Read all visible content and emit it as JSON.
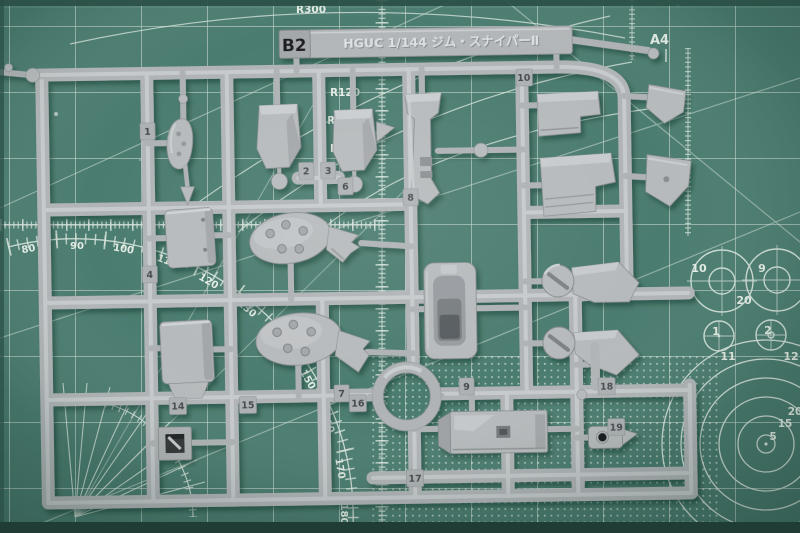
{
  "scene": {
    "description": "Photograph of a light gray plastic model kit runner (sprue B2 of HGUC 1/144 GM Sniper II) lying on a green A4 self-healing cutting mat with white grid, protractor arcs and circle templates"
  },
  "sprue": {
    "tag_label": "B2",
    "kit_label": "HGUC 1/144 ジム・スナイパーⅡ",
    "plastic_color": "#b6babc",
    "part_numbers": [
      "1",
      "2",
      "3",
      "4",
      "6",
      "7",
      "8",
      "9",
      "10",
      "14",
      "15",
      "16",
      "17",
      "18",
      "19"
    ]
  },
  "mat": {
    "surface_color": "#4b7c70",
    "grid_color": "#d5e2da",
    "sheet_size_label": "A4",
    "radius_labels": [
      "R300",
      "R120",
      "R100",
      "R80"
    ],
    "protractor_labels": [
      "80",
      "90",
      "100",
      "110",
      "120",
      "130",
      "150",
      "160",
      "170",
      "180"
    ],
    "diameter_circle_labels": [
      "10",
      "9",
      "20",
      "1",
      "2",
      "11",
      "12"
    ],
    "target_circle_labels": [
      "20",
      "15",
      "5"
    ]
  }
}
